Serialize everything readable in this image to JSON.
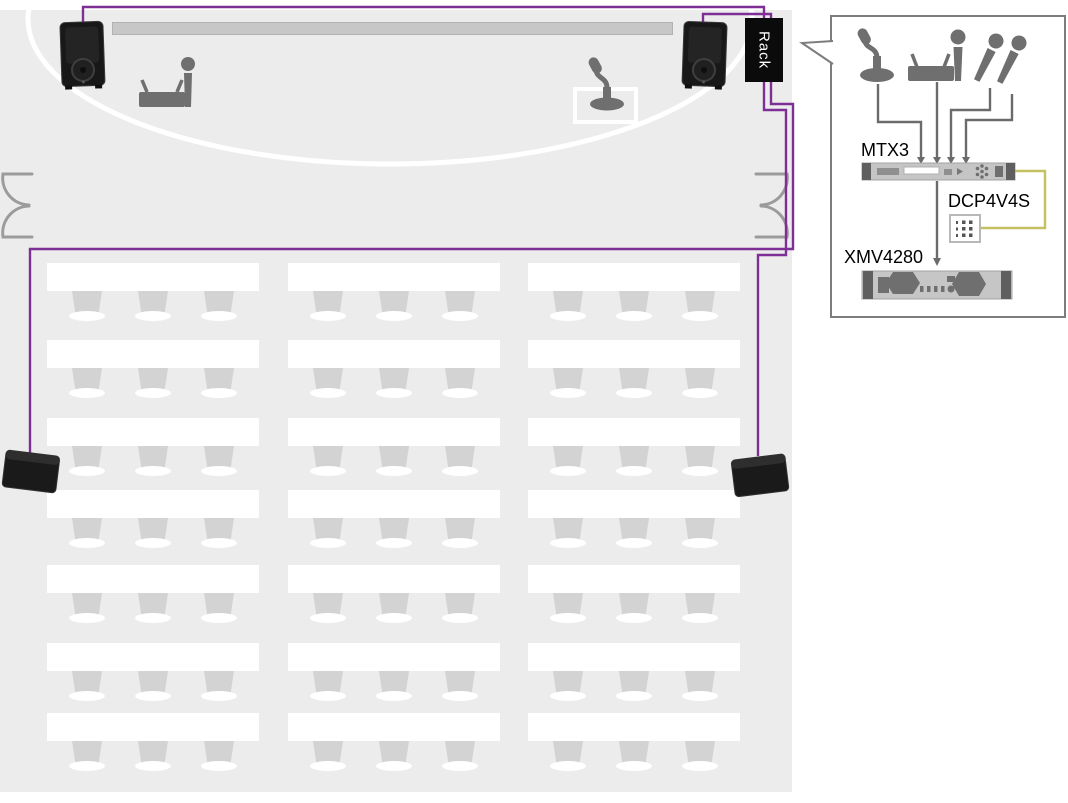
{
  "room": {
    "rack_label": "Rack",
    "furniture": {
      "table_cols_x": [
        47,
        288,
        528
      ],
      "table_rows_y": [
        263,
        340,
        418,
        490,
        565,
        643,
        713
      ],
      "table_w": 212,
      "table_h": 28,
      "chair_offsets": [
        40,
        106,
        172
      ],
      "chair_w": 30,
      "chair_h": 24
    },
    "icons": [
      "stage-speaker-left",
      "stage-speaker-right",
      "wireless-mic-set",
      "gooseneck-mic-on-podium",
      "double-door-left",
      "double-door-right",
      "wall-speaker-left",
      "wall-speaker-right",
      "screen"
    ]
  },
  "callout": {
    "devices": {
      "mixer": "MTX3",
      "controller": "DCP4V4S",
      "amplifier": "XMV4280"
    },
    "input_icons": [
      "gooseneck-mic",
      "wireless-receiver",
      "handheld-mic",
      "wireless-handheld-mic-1",
      "wireless-handheld-mic-2"
    ]
  },
  "colors": {
    "floor": "#ececec",
    "speaker_cable": "#7e2f95",
    "control_cable": "#c3c162",
    "icon_gray": "#6f6f6f",
    "connector_gray": "#6b6b6b",
    "rack_bg": "#0b0b0b",
    "table": "#ffffff",
    "chair": "#d3d3d3",
    "screen": "#c7c7c7",
    "callout_border": "#7d7d7d",
    "equipment_body": "#c5c5c5",
    "equipment_cap": "#5f5f5f"
  }
}
